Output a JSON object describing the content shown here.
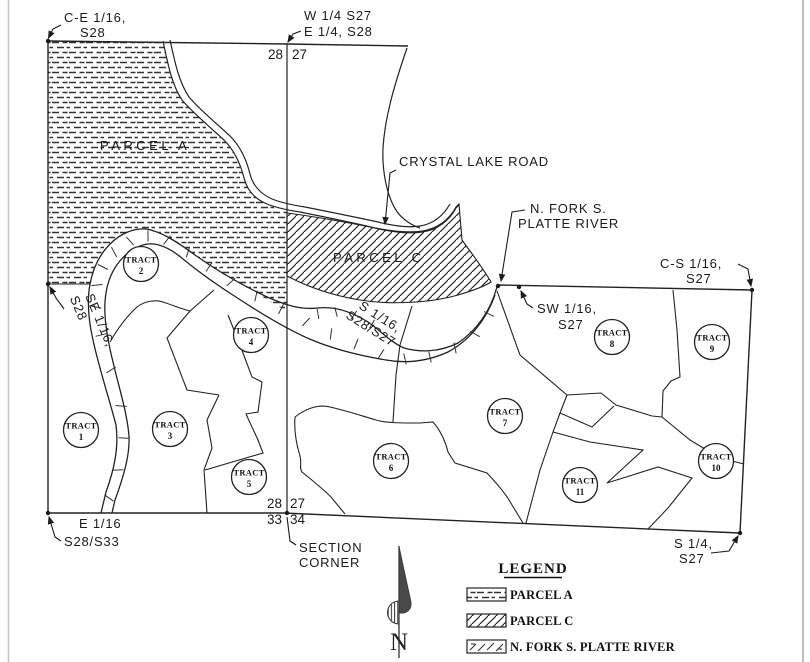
{
  "map": {
    "corners": {
      "ce16_l1": "C-E 1/16,",
      "ce16_l2": "S28",
      "w14_l1": "W 1/4 S27",
      "w14_l2": "E 1/4, S28",
      "top_sec_left": "28",
      "top_sec_right": "27",
      "cs16_l1": "C-S 1/16,",
      "cs16_l2": "S27",
      "sw16_l1": "SW 1/16,",
      "sw16_l2": "S27",
      "se16_l1": "SE 1/16,",
      "se16_l2": "S28",
      "s16_l1": "S 1/16,",
      "s16_l2": "S28/S27",
      "e16_l1": "E 1/16",
      "e16_l2": "S28/S33",
      "sc_28": "28",
      "sc_27": "27",
      "sc_33": "33",
      "sc_34": "34",
      "section_corner_l1": "SECTION",
      "section_corner_l2": "CORNER",
      "s14_l1": "S 1/4,",
      "s14_l2": "S27"
    },
    "features": {
      "parcel_a": "PARCEL A",
      "parcel_c": "PARCEL C",
      "road": "CRYSTAL LAKE ROAD",
      "river_l1": "N. FORK S.",
      "river_l2": "PLATTE RIVER"
    },
    "north_label": "N",
    "tracts": [
      {
        "w": "TRACT",
        "n": "1"
      },
      {
        "w": "TRACT",
        "n": "2"
      },
      {
        "w": "TRACT",
        "n": "3"
      },
      {
        "w": "TRACT",
        "n": "4"
      },
      {
        "w": "TRACT",
        "n": "5"
      },
      {
        "w": "TRACT",
        "n": "6"
      },
      {
        "w": "TRACT",
        "n": "7"
      },
      {
        "w": "TRACT",
        "n": "8"
      },
      {
        "w": "TRACT",
        "n": "9"
      },
      {
        "w": "TRACT",
        "n": "10"
      },
      {
        "w": "TRACT",
        "n": "11"
      }
    ]
  },
  "legend": {
    "title": "LEGEND",
    "items": [
      {
        "swatch": "parcel-a-hatch",
        "label": "PARCEL A"
      },
      {
        "swatch": "parcel-c-hatch",
        "label": "PARCEL C"
      },
      {
        "swatch": "river-hatch",
        "label": "N. FORK S. PLATTE RIVER"
      }
    ]
  },
  "colors": {
    "ink": "#1b1b1b",
    "background": "#ffffff",
    "scan_edge": "#c8c8c8"
  }
}
